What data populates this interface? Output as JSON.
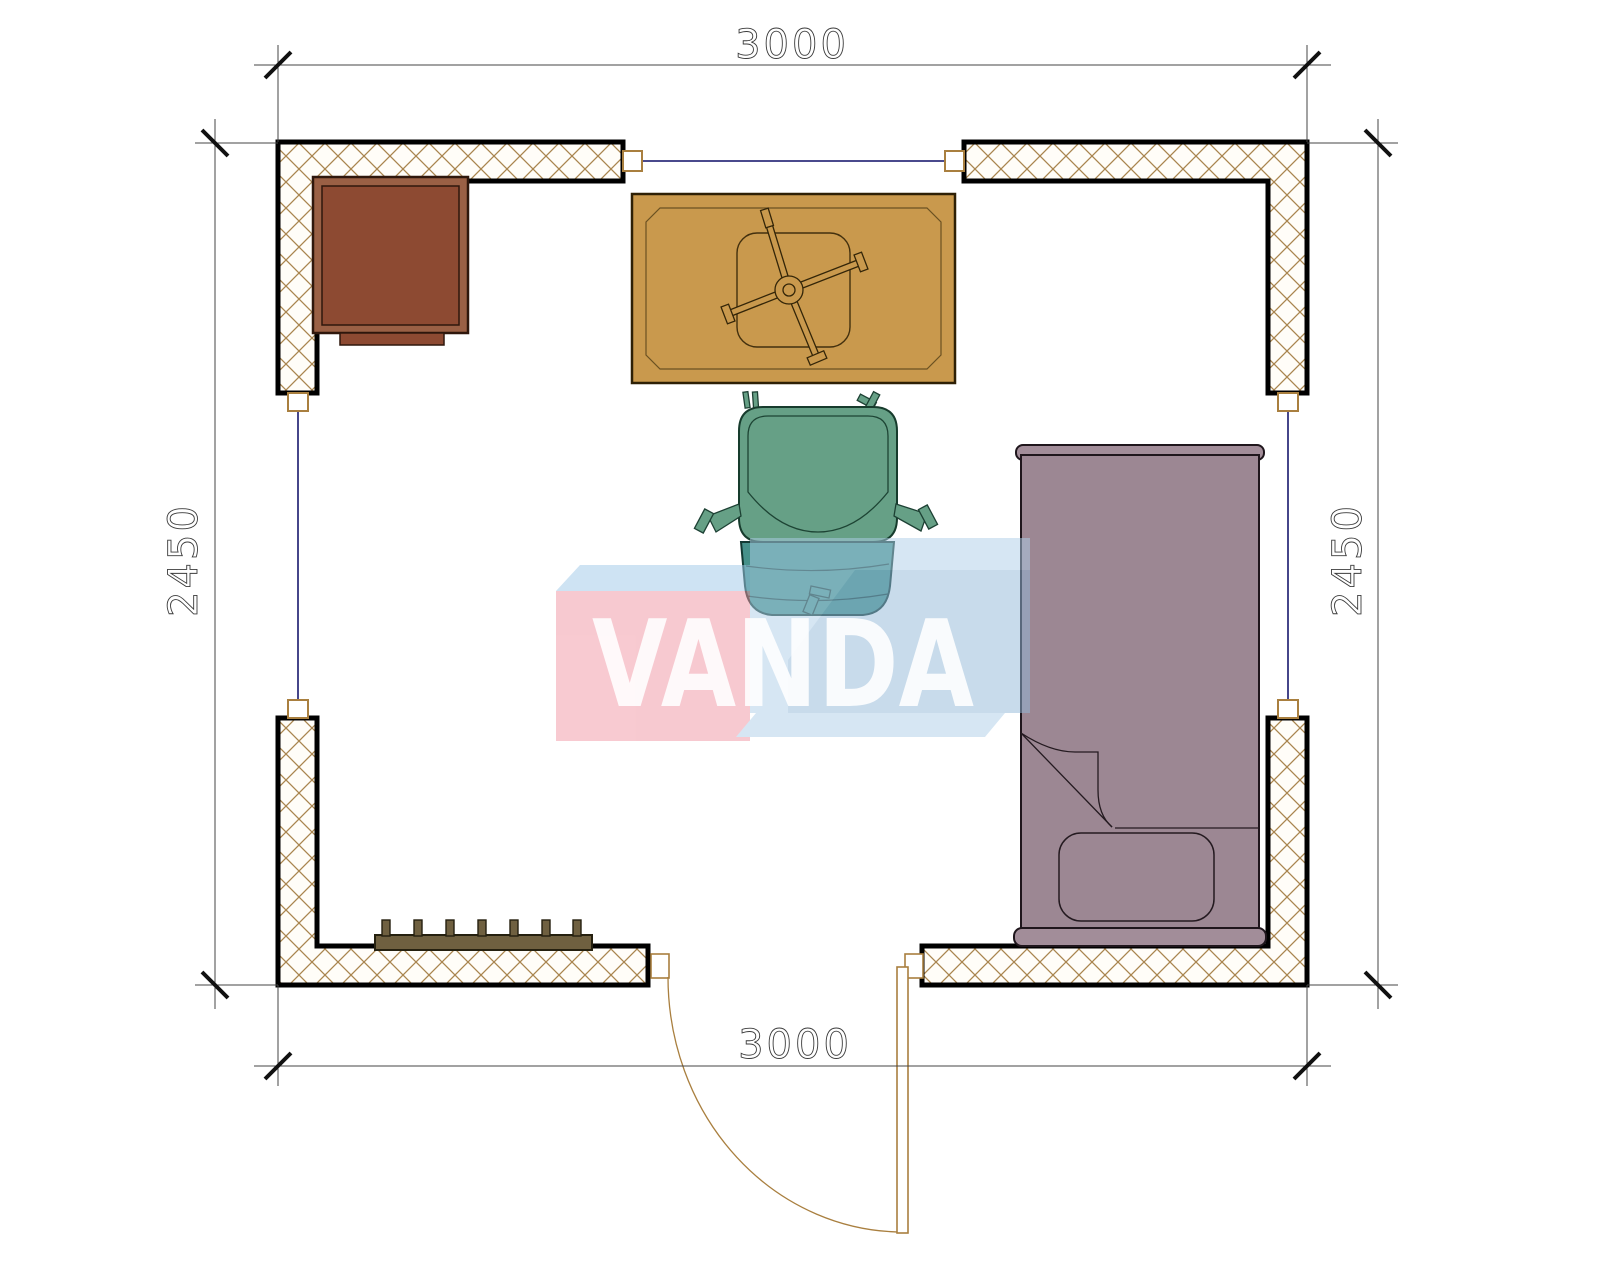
{
  "document": {
    "type": "floor-plan-preview"
  },
  "watermark": {
    "text": "VANDA",
    "pink_color": "#f8cad1",
    "blue_color": "#d7e7f4",
    "top_face_color": "#cfe4f4"
  },
  "dimensions": {
    "width_top_mm": "3000",
    "width_bottom_mm": "3000",
    "height_left_mm": "2450",
    "height_right_mm": "2450"
  },
  "room": {
    "furniture": [
      "corner-cabinet",
      "table-with-swivel-base",
      "office-chair",
      "single-bed",
      "radiator"
    ],
    "openings": [
      "door-bottom",
      "window-top",
      "window-left",
      "window-right"
    ]
  },
  "colors": {
    "wall_hatch": "#a9854f",
    "wall_outline": "#000000",
    "window_glass": "#31317d",
    "door_line": "#a97f3f",
    "cabinet_fill": "#8d4a32",
    "table_fill": "#c9994d",
    "chair_seat": "#66a086",
    "chair_back": "#46918a",
    "bed_fill": "#9c8793",
    "radiator_fill": "#6f6040",
    "dimension_text": "#3b3b3b"
  }
}
